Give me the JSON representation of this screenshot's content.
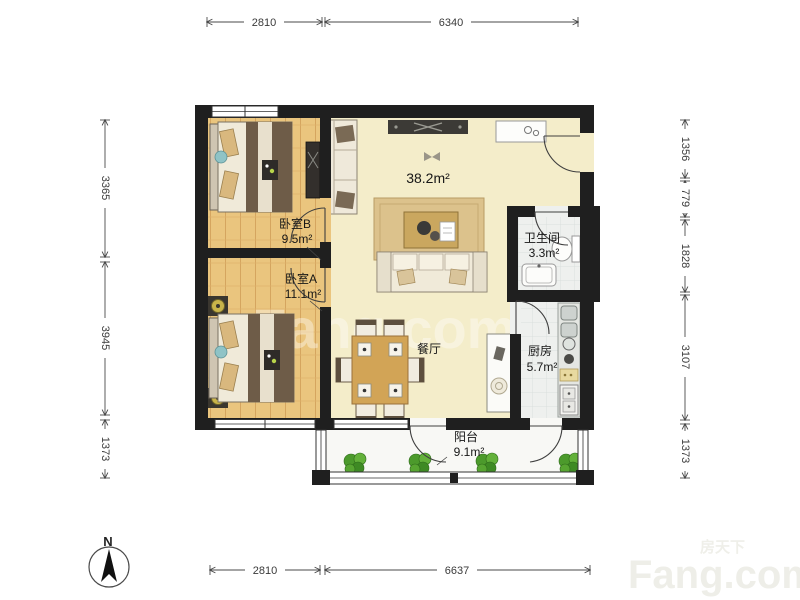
{
  "page": {
    "background": "#ffffff"
  },
  "compass": {
    "label": "N"
  },
  "watermark": {
    "brand": "Fang.com",
    "brand_cn": "房天下"
  },
  "rooms": {
    "bedroom_b": {
      "name": "卧室B",
      "area": "9.5m²"
    },
    "bedroom_a": {
      "name": "卧室A",
      "area": "11.1m²"
    },
    "living": {
      "area": "38.2m²"
    },
    "dining": {
      "name": "餐厅"
    },
    "bathroom": {
      "name": "卫生间",
      "area": "3.3m²"
    },
    "kitchen": {
      "name": "厨房",
      "area": "5.7m²"
    },
    "balcony": {
      "name": "阳台",
      "area": "9.1m²"
    }
  },
  "dimensions": {
    "top": [
      "2810",
      "6340"
    ],
    "bottom": [
      "2810",
      "6637"
    ],
    "left": [
      "3365",
      "3945",
      "1373"
    ],
    "right": [
      "1356",
      "779",
      "1828",
      "3107",
      "1373"
    ]
  },
  "colors": {
    "wall": "#1f1f1f",
    "wood_floor": "#eac57e",
    "living_floor": "#f4edca",
    "tile_floor": "#eef0ee",
    "balcony_floor": "#f8f8f5",
    "plant_green": "#55a52f",
    "dimension_text": "#3a3a3a"
  }
}
